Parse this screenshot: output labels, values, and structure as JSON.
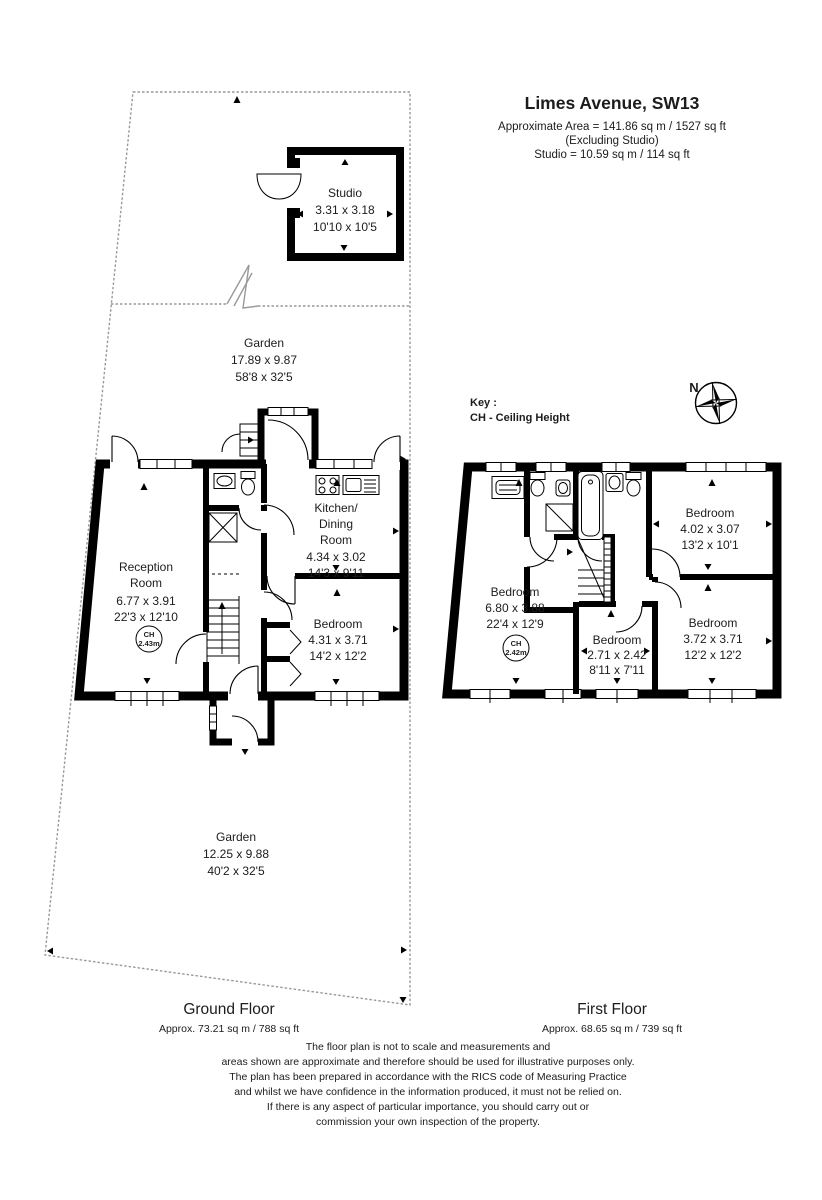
{
  "title_block": {
    "address": "Limes Avenue, SW13",
    "area_line": "Approximate Area = 141.86 sq m / 1527 sq ft",
    "excluding_line": "(Excluding Studio)",
    "studio_area_line": "Studio = 10.59 sq m / 114 sq ft"
  },
  "key_block": {
    "label": "Key :",
    "ceiling_height": "CH - Ceiling Height"
  },
  "compass": {
    "north": "N"
  },
  "studio": {
    "name": "Studio",
    "dims_m": "3.31 x 3.18",
    "dims_ft": "10'10 x 10'5"
  },
  "gardens": {
    "top": {
      "name": "Garden",
      "dims_m": "17.89 x 9.87",
      "dims_ft": "58'8 x 32'5"
    },
    "bottom": {
      "name": "Garden",
      "dims_m": "12.25 x 9.88",
      "dims_ft": "40'2 x 32'5"
    }
  },
  "ground_floor": {
    "floor_label": "Ground Floor",
    "floor_area": "Approx. 73.21 sq m / 788 sq ft",
    "reception": {
      "name_1": "Reception",
      "name_2": "Room",
      "dims_m": "6.77 x 3.91",
      "dims_ft": "22'3 x 12'10",
      "ch_label": "CH",
      "ch_value": "2.43m"
    },
    "kitchen": {
      "name_1": "Kitchen/",
      "name_2": "Dining",
      "name_3": "Room",
      "dims_m": "4.34 x 3.02",
      "dims_ft": "14'3 x 9'11"
    },
    "bedroom": {
      "name": "Bedroom",
      "dims_m": "4.31 x 3.71",
      "dims_ft": "14'2 x 12'2"
    }
  },
  "first_floor": {
    "floor_label": "First Floor",
    "floor_area": "Approx. 68.65 sq m / 739 sq ft",
    "bedroom_main": {
      "name": "Bedroom",
      "dims_m": "6.80 x 3.88",
      "dims_ft": "22'4 x 12'9",
      "ch_label": "CH",
      "ch_value": "2.42m"
    },
    "bedroom_top_right": {
      "name": "Bedroom",
      "dims_m": "4.02 x 3.07",
      "dims_ft": "13'2 x 10'1"
    },
    "bedroom_middle": {
      "name": "Bedroom",
      "dims_m": "2.71 x 2.42",
      "dims_ft": "8'11 x 7'11"
    },
    "bedroom_bottom_right": {
      "name": "Bedroom",
      "dims_m": "3.72 x 3.71",
      "dims_ft": "12'2 x 12'2"
    }
  },
  "disclaimer": {
    "line_1": "The floor plan is not to scale and measurements and",
    "line_2": "areas shown are approximate and therefore should be used for illustrative purposes only.",
    "line_3": "The plan has been prepared in accordance with the RICS code of Measuring Practice",
    "line_4": "and whilst we have confidence in the information produced, it must not be relied on.",
    "line_5": "If there is any aspect of particular importance, you should carry out or",
    "line_6": "commission your own inspection of the property."
  },
  "colors": {
    "background": "#ffffff",
    "walls": "#000000",
    "text": "#1c1c1c",
    "plot_line": "#999999"
  }
}
